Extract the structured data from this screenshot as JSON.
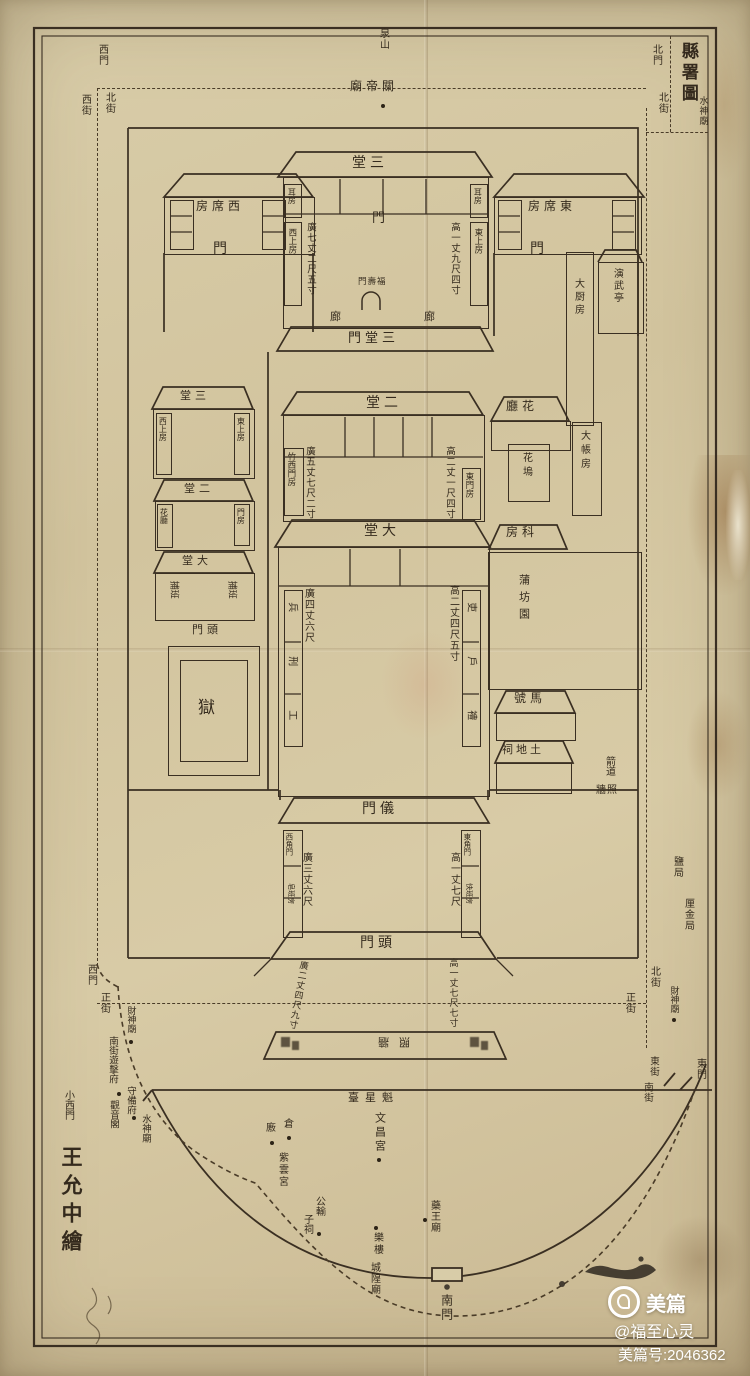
{
  "colors": {
    "paper": "#d3c6a2",
    "ink": "#352b1f",
    "watermark_text": "#ffffff"
  },
  "title": {
    "main": "縣署圖",
    "sub": "水神廟"
  },
  "compass_streets": {
    "north_gate": "北門",
    "north_street_right": "北街",
    "west_gate_top": "西門",
    "west_street": "西街",
    "north_street_left": "北街",
    "hill": "泉山",
    "guandi_temple": "關帝廟"
  },
  "central_axis": {
    "santang": "三堂",
    "santang_gate": "三堂門",
    "ertang": "二堂",
    "datang": "大堂",
    "yimen": "儀門",
    "toumen": "頭門",
    "fushou_gate": "福壽門",
    "corridor_left": "廊",
    "corridor_right": "廊",
    "hall_door": "門",
    "screen_wall": "照牆"
  },
  "rooms": {
    "west_guest": "西席房",
    "west_guest_gate": "門",
    "east_guest": "東席房",
    "east_guest_gate": "門",
    "ear_room_w": "耳房",
    "ear_room_e": "耳房",
    "west_upper": "西上房",
    "east_upper": "東上房",
    "drill_pavilion": "演武亭",
    "kitchen": "大厨房",
    "zhuxi_gate_room": "竹西門房",
    "east_gate_room": "東門房",
    "flower_hall": "花廳",
    "flower_bed": "花塢",
    "accounts_room": "大帳房",
    "clerks_room": "科房",
    "pufang_garden": "蒲坊園",
    "stable": "馬號",
    "earth_god_shrine": "土地祠",
    "archery_lane": "箭道",
    "screen_wall_small": "照牆",
    "prison": "獄",
    "constables": "捕班",
    "west_corner_gate": "西角門",
    "east_corner_gate": "東角門",
    "west_runners": "皂班房",
    "east_runners": "快班房",
    "toumen_small": "頭門"
  },
  "annex": {
    "santang": "三堂",
    "west_upper": "西上房",
    "east_upper": "東上房",
    "ertang": "二堂",
    "flower_hall": "花廳",
    "gate_room": "門房",
    "datang": "大堂"
  },
  "six_offices": {
    "e1": "吏",
    "e2": "戶",
    "e3": "禮",
    "w1": "兵",
    "w2": "刑",
    "w3": "工"
  },
  "dimensions": {
    "santang_w": "廣七丈二尺五寸",
    "santang_h": "高一丈九尺四寸",
    "ertang_w": "廣五丈七尺二寸",
    "ertang_h": "高二丈一尺四寸",
    "datang_w": "廣四丈六尺",
    "datang_h": "高二丈四尺五寸",
    "yimen_w": "廣三丈六尺",
    "yimen_h": "高一丈七尺",
    "toumen_w": "廣二丈四尺九寸",
    "toumen_h": "高一丈七尺七寸"
  },
  "south_quarter": {
    "kuixing_terrace": "魁星臺",
    "wenchang_palace": "文昌宮",
    "granary": "倉",
    "granary2": "廒",
    "ziyun_palace": "紫雲宮",
    "gongshu": "公輸",
    "zici": "子祠",
    "yaowang_temple": "藥王廟",
    "opera_tower": "樂樓",
    "chenghuang_temple": "城隍廟",
    "south_gate": "南門"
  },
  "west_side": {
    "gate": "西門",
    "main_street": "正街",
    "caishen_temple": "財神廟",
    "garrison": "南街遊擊府",
    "shoubei_office": "守備府",
    "small_west_gate": "小西門",
    "guanyin_pavilion": "觀音閣",
    "water_god_temple": "水神廟"
  },
  "east_side": {
    "salt_bureau": "鹽局",
    "likin_bureau": "厘金局",
    "north_street": "北街",
    "main_street": "正街",
    "caishen_temple": "財神廟",
    "east_street": "東街",
    "east_gate": "東門",
    "south_street": "南街"
  },
  "credit": "王允中繪",
  "watermark": {
    "brand": "美篇",
    "handle": "@福至心灵",
    "id": "美篇号:2046362"
  }
}
